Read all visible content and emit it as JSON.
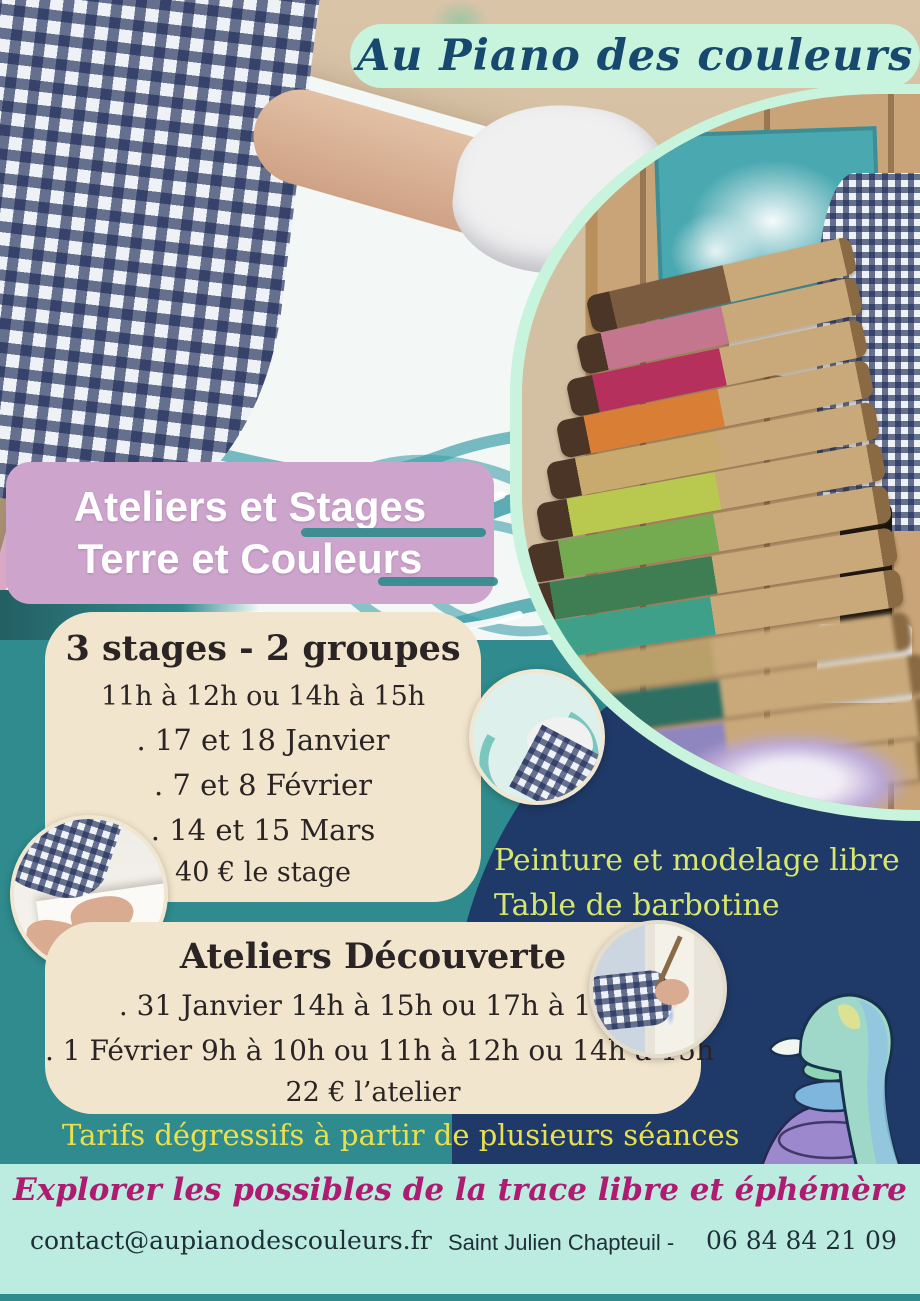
{
  "title": "Au Piano des couleurs",
  "banner": {
    "line1": "Ateliers et Stages",
    "line2": "Terre et Couleurs"
  },
  "stages_box": {
    "heading": "3 stages - 2 groupes",
    "times": "11h à 12h ou 14h à 15h",
    "dates": [
      ". 17 et 18 Janvier",
      ". 7 et 8 Février",
      ". 14 et 15 Mars"
    ],
    "price": "40 € le stage"
  },
  "side_note": {
    "line1": "Peinture et modelage libre",
    "line2": "Table de barbotine"
  },
  "decouverte_box": {
    "heading": "Ateliers Découverte",
    "sessions": [
      ". 31 Janvier 14h à 15h ou 17h à 18h",
      ". 1 Février 9h à 10h ou 11h à 12h ou 14h à 15h"
    ],
    "price": "22 € l’atelier"
  },
  "tariff_note": "Tarifs dégressifs à partir de plusieurs séances",
  "tagline": "Explorer les possibles de la trace libre et éphémère",
  "footer": {
    "email": "contact@aupianodescouleurs.fr",
    "location": "Saint Julien Chapteuil -",
    "phone": "06 84 84 21 09"
  },
  "colors": {
    "background_teal": "#2F8B8D",
    "navy_panel": "#1F3A68",
    "banner_pink": "#CDA4CC",
    "card_cream": "#F2E5CD",
    "mint_pill": "#C8F3DD",
    "footer_mint": "#BCECDF",
    "title_text": "#17486D",
    "accent_yellow": "#E9E04E",
    "accent_yellow_green": "#D7E76E",
    "tagline_magenta": "#B01B72",
    "card_text": "#2B2424"
  },
  "photos": {
    "main_photo": "children-finger-painting-large-canvas",
    "side_photo": "paintbrushes-on-ledge-with-child-painting",
    "circle_photo_1": "gloved-hand-painting-swirls",
    "circle_photo_2": "child-hands-pressing-clay",
    "circle_photo_3": "child-painting-at-easel",
    "sketch": "watercolor-figure-sketch",
    "brush_colors": [
      "#7A5B40",
      "#C4768F",
      "#B5305C",
      "#D87F35",
      "#C8A96E",
      "#B9C94F",
      "#74AA50",
      "#3F7D52",
      "#3FA08A",
      "#B9A06A",
      "#2E6F63",
      "#8F86C0",
      "#6F5FA8"
    ]
  }
}
